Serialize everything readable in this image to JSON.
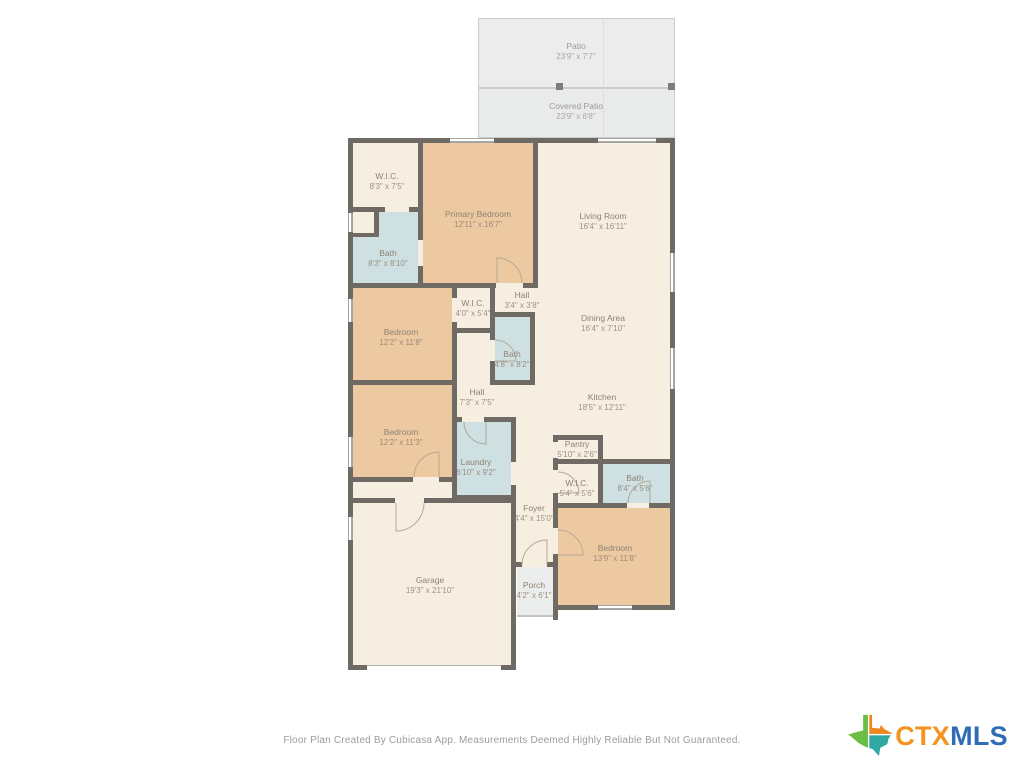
{
  "floor_plan": {
    "rooms": {
      "patio": {
        "name": "Patio",
        "dims": "23'9\" x 7'7\""
      },
      "covered_patio": {
        "name": "Covered Patio",
        "dims": "23'9\" x 6'8\""
      },
      "wic_primary": {
        "name": "W.I.C.",
        "dims": "8'3\" x 7'5\""
      },
      "primary_bedroom": {
        "name": "Primary Bedroom",
        "dims": "12'11\" x 16'7\""
      },
      "bath_primary": {
        "name": "Bath",
        "dims": "8'3\" x 8'10\""
      },
      "living_room": {
        "name": "Living Room",
        "dims": "16'4\" x 16'11\""
      },
      "bedroom_2": {
        "name": "Bedroom",
        "dims": "12'2\" x 11'8\""
      },
      "wic_2": {
        "name": "W.I.C.",
        "dims": "4'0\" x 5'4\""
      },
      "hall_1": {
        "name": "Hall",
        "dims": "3'4\" x 3'8\""
      },
      "dining_area": {
        "name": "Dining Area",
        "dims": "16'4\" x 7'10\""
      },
      "bath_hall": {
        "name": "Bath",
        "dims": "4'8\" x 8'2\""
      },
      "hall_2": {
        "name": "Hall",
        "dims": "7'3\" x 7'5\""
      },
      "kitchen": {
        "name": "Kitchen",
        "dims": "18'5\" x 12'11\""
      },
      "bedroom_3": {
        "name": "Bedroom",
        "dims": "12'2\" x 11'3\""
      },
      "laundry": {
        "name": "Laundry",
        "dims": "6'10\" x 9'2\""
      },
      "pantry": {
        "name": "Pantry",
        "dims": "5'10\" x 2'6\""
      },
      "wic_3": {
        "name": "W.I.C.",
        "dims": "5'4\" x 5'6\""
      },
      "bath_3": {
        "name": "Bath",
        "dims": "8'4\" x 5'6\""
      },
      "foyer": {
        "name": "Foyer",
        "dims": "4'4\" x 15'0\""
      },
      "bedroom_4": {
        "name": "Bedroom",
        "dims": "13'9\" x 11'8\""
      },
      "garage": {
        "name": "Garage",
        "dims": "19'3\" x 21'10\""
      },
      "porch": {
        "name": "Porch",
        "dims": "4'2\" x 6'1\""
      }
    },
    "footer": {
      "disclaimer": "Floor Plan Created By Cubicasa App. Measurements Deemed Highly Reliable But Not Guaranteed."
    },
    "logo": {
      "ctx": "CTX",
      "mls": "MLS"
    },
    "colors": {
      "wall": "#6f6a64",
      "room_cream": "#f7eee2",
      "room_tan": "#edc9a1",
      "room_bath": "#cee0e1",
      "outdoor_gray": "#ececec",
      "label_text": "#8e8274",
      "ctx_orange": "#f6921e",
      "mls_blue": "#2e6db5"
    }
  }
}
